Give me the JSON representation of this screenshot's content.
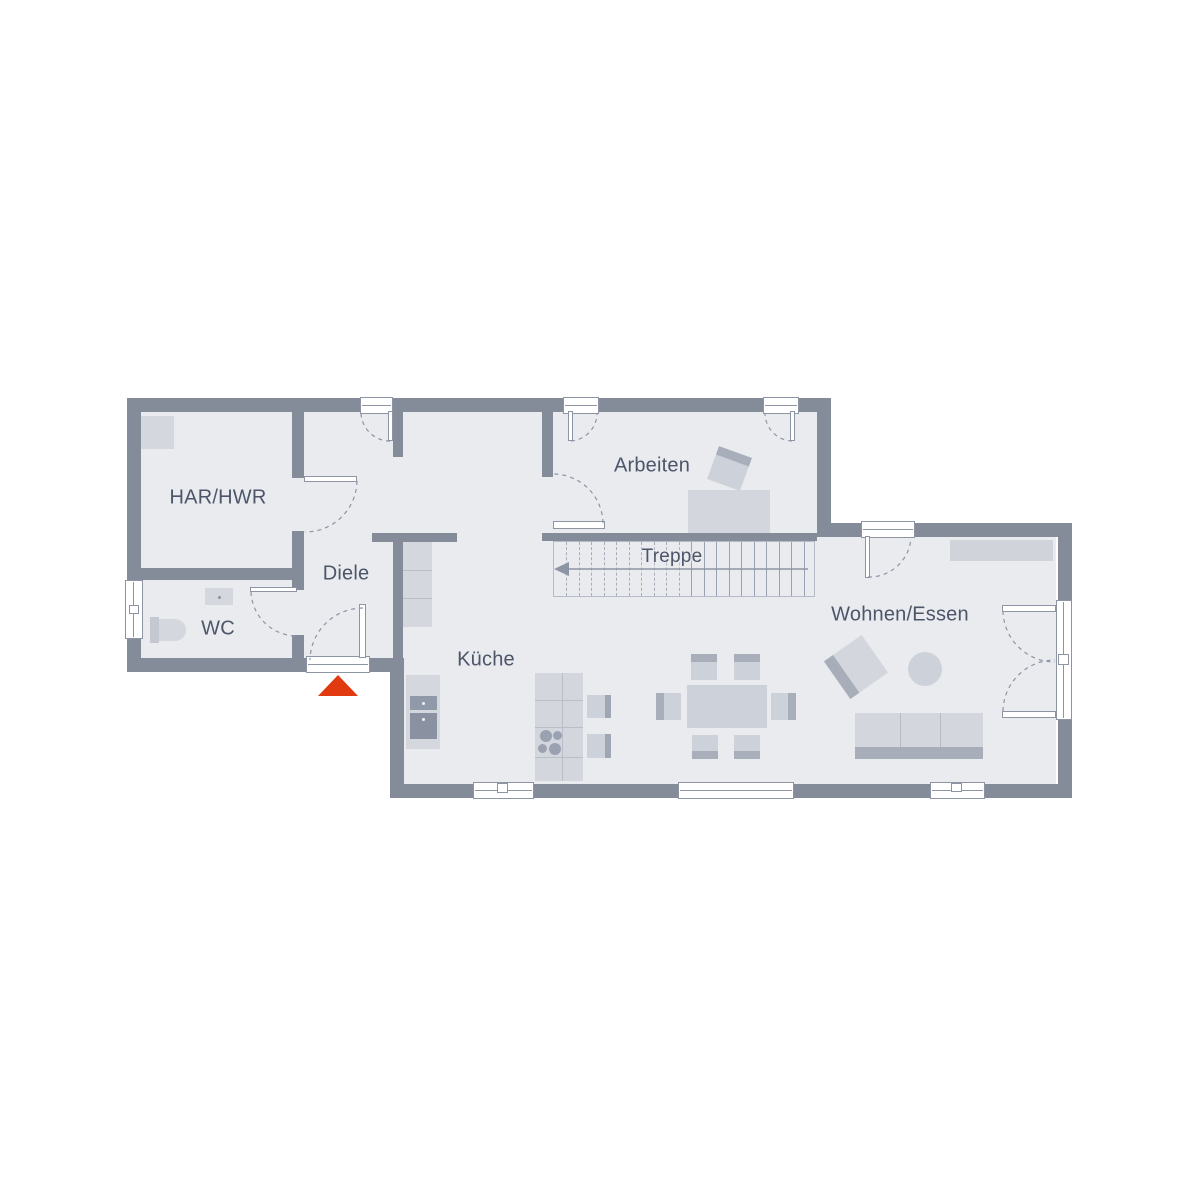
{
  "floorplan": {
    "type": "ground-floor-plan",
    "rooms": {
      "har_hwr": "HAR/HWR",
      "diele": "Diele",
      "wc": "WC",
      "arbeiten": "Arbeiten",
      "treppe": "Treppe",
      "kueche": "Küche",
      "wohnen_essen": "Wohnen/Essen"
    },
    "stairs": {
      "treads": 21,
      "direction_arrow": "left"
    },
    "markers": {
      "entrance_arrow": "entrance"
    },
    "colors": {
      "wall": "#848b99",
      "floor": "#e9ebef",
      "furniture_light": "#d4d7de",
      "furniture_mid": "#cdd1d9",
      "furniture_dark": "#a8aeba",
      "appliance": "#9099a8",
      "line": "#8d95a4",
      "label_text": "#4d5568",
      "entrance_arrow": "#e23a10",
      "background": "#ffffff"
    }
  }
}
